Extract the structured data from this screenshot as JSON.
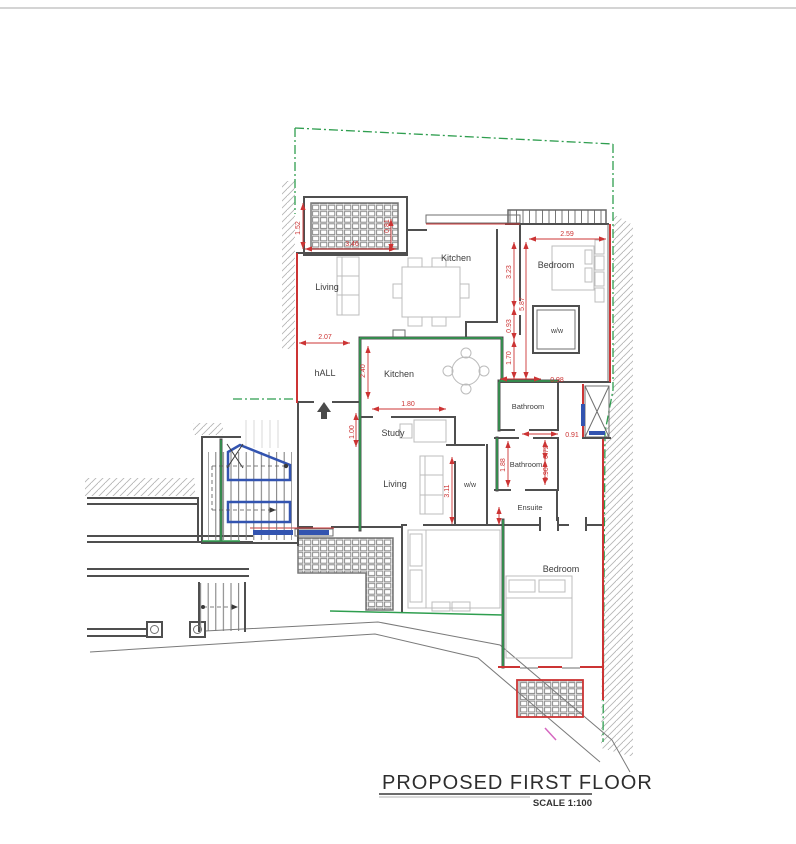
{
  "title_block": {
    "title": "PROPOSED FIRST FLOOR",
    "scale_label": "SCALE 1:100"
  },
  "rooms": {
    "living_top": "Living",
    "kitchen_top": "Kitchen",
    "bedroom_top": "Bedroom",
    "ww_top": "w/w",
    "hall": "hALL",
    "kitchen_mid": "Kitchen",
    "bathroom_top": "Bathroom",
    "bathroom_mid": "Bathroom",
    "study": "Study",
    "living_mid": "Living",
    "ww_mid": "w/w",
    "ensuite": "Ensuite",
    "bedroom_bottom": "Bedroom"
  },
  "dimensions_m": {
    "terrace_height": "1.52",
    "terrace_width": "3.46",
    "kitchen_front_offset": "0.81",
    "bedroom_width": "2.59",
    "bedroom_depth": "3.23",
    "east_side_total": "5.87",
    "wall_step": "0.93",
    "wardrobe_depth": "1.70",
    "hall_width": "2.07",
    "kitchen_depth": "2.40",
    "study_width": "1.80",
    "study_side": "1.00",
    "bathroom1_width": "0.98",
    "bathroom2_width": "0.91",
    "bathroom_split_a": "0.72",
    "bathroom_split_b": "0.90",
    "bathroom2_depth": "1.88",
    "corridor_length": "3.11"
  },
  "colors": {
    "boundary": "#2f9e4f",
    "dimension": "#cc3434",
    "stairs": "#3354b0",
    "walls": "#4f4f4f"
  }
}
